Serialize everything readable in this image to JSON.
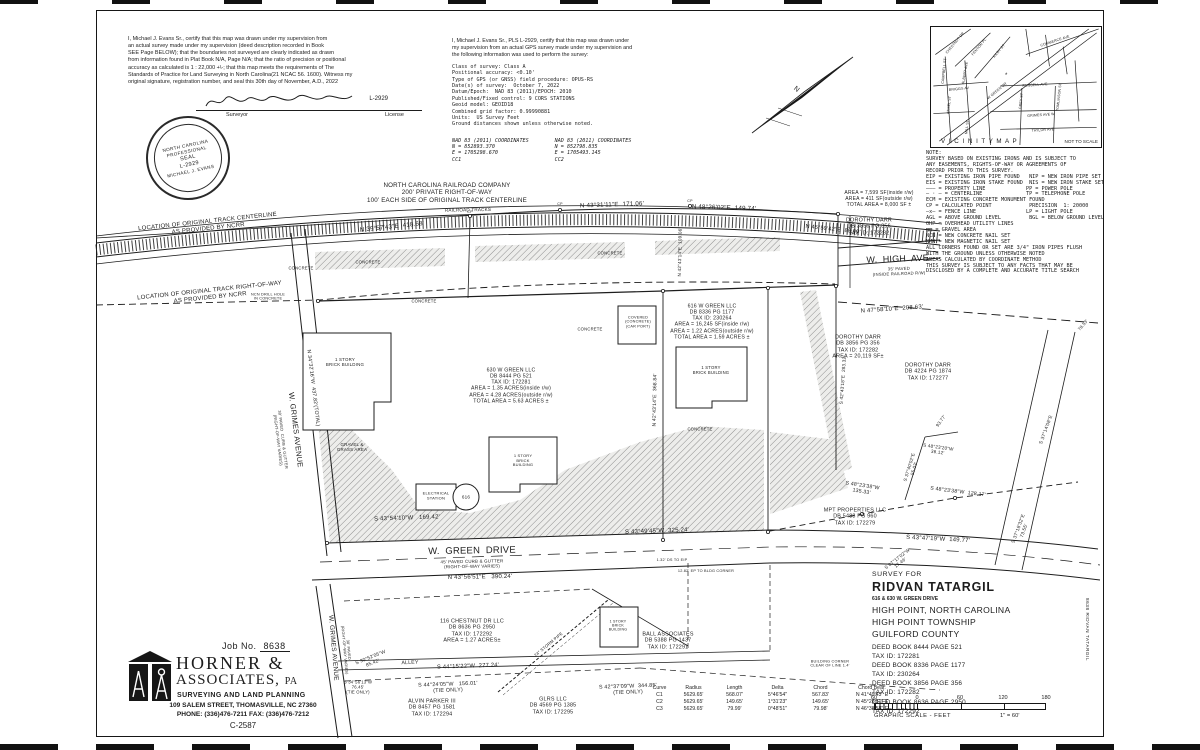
{
  "page": {
    "paper": "#ffffff",
    "ink": "#1d1d1d",
    "hatch_gray": "#8f8f8f"
  },
  "cert_left": {
    "body": "I, Michael J. Evans Sr., certify that this map was drawn under my supervision from\nan actual survey made under my supervision (deed description recorded in Book\nSEE Page BELOW); that the boundaries not surveyed are clearly indicated as drawn\nfrom information found in Plat Book N/A, Page N/A; that the ratio of precision or positional\naccuracy as calculated is 1 : 22,000 +\\-; that this map meets the requirements of The\nStandards of Practice for Land Surveying in North Carolina(21 NCAC 56. 1600). Witness my\noriginal signature, registration number, and seal this 30th day of November, A.D., 2022",
    "sig_license": "L-2929",
    "surveyor_label": "Surveyor",
    "license_label": "License"
  },
  "seal": {
    "arc_top": "NORTH CAROLINA",
    "line2": "PROFESSIONAL",
    "line3": "SEAL",
    "line4": "L-2929",
    "arc_bottom": "MICHAEL J. EVANS"
  },
  "cert_gps": {
    "intro": "I, Michael J. Evans Sr., PLS L-2929, certify that this map was drawn under\nmy supervision from an actual GPS survey made under my supervision and\nthe following information was used to perform the survey:",
    "details": "Class of survey: Class A\nPositional accuracy: <0.10'\nType of GPS (or GNSS) field procedure: OPUS-RS\nDate(s) of survey:  October 7, 2022\nDatum/Epoch:  NAD 83 (2011)/EPOCH: 2010\nPublished/Fixed control: 9 CORS STATIONS\nGeoid model: GEOID18\nCombined grid factor: 0.99990881\nUnits:  US Survey Feet\nGround distances shown unless otherwise noted.",
    "coords_left": "NAD 83 (2011) COORDINATES\nN = 852893.370\nE = 1705298.670\nCC1",
    "coords_right": "NAD 83 (2011) COORDINATES\nN = 852798.835\nE = 1705493.145\nCC2"
  },
  "vicinity": {
    "title": "V I C I N I T Y   M A P",
    "not_to_scale": "NOT TO SCALE",
    "site_marker": "*",
    "streets": [
      {
        "t": "CHESTNUT DR",
        "x": 24,
        "y": 16,
        "r": -50
      },
      {
        "t": "FENTON PL",
        "x": 48,
        "y": 20,
        "r": -50
      },
      {
        "t": "KILBY ST",
        "x": 68,
        "y": 24,
        "r": -50
      },
      {
        "t": "CAMPBELL ST",
        "x": 13,
        "y": 44,
        "r": -84
      },
      {
        "t": "ALBERT AVE",
        "x": 34,
        "y": 46,
        "r": -80
      },
      {
        "t": "BRIGGS AV",
        "x": 28,
        "y": 62,
        "r": -6
      },
      {
        "t": "ANSEL ST",
        "x": 18,
        "y": 78,
        "r": -84
      },
      {
        "t": "MILL ST",
        "x": 36,
        "y": 100,
        "r": -84
      },
      {
        "t": "W GREEN DR",
        "x": 66,
        "y": 64,
        "r": -40
      },
      {
        "t": "COMMERCE AVE",
        "x": 124,
        "y": 14,
        "r": -18
      },
      {
        "t": "RUSSELL AVE",
        "x": 104,
        "y": 58,
        "r": -4
      },
      {
        "t": "GREY ST",
        "x": 90,
        "y": 74,
        "r": -84
      },
      {
        "t": "TOMLINSON ST",
        "x": 128,
        "y": 70,
        "r": -84
      },
      {
        "t": "GRIMES AVE W",
        "x": 110,
        "y": 88,
        "r": -4
      },
      {
        "t": "TAYLOR AVE",
        "x": 112,
        "y": 103,
        "r": -4
      }
    ]
  },
  "notes": {
    "text": "NOTE:\nSURVEY BASED ON EXISTING IRONS AND IS SUBJECT TO\nANY EASEMENTS, RIGHTS-OF-WAY OR AGREEMENTS OF\nRECORD PRIOR TO THIS SURVEY.\nEIP = EXISTING IRON PIPE FOUND   NIP = NEW IRON PIPE SET\nEIS = EXISTING IRON STAKE FOUND  NIS = NEW IRON STAKE SET\n——— = PROPERTY LINE             PP = POWER POLE\n— · — = CENTERLINE              TP = TELEPHONE POLE\nECM = EXISTING CONCRETE MONUMENT FOUND\nCP = CALCULATED POINT            PRECISION  1: 20000\n—x— = FENCE LINE                LP = LIGHT POLE\nAGL = ABOVE GROUND LEVEL         BGL = BELOW GROUND LEVEL\nOHP = OVERHEAD UTILITY LINES\n▨▨ = GRAVEL AREA\nNCN = NEW CONCRETE NAIL SET\nNMN = NEW MAGNETIC NAIL SET\nALL CORNERS FOUND OR SET ARE 3/4\" IRON PIPES FLUSH\nWITH THE GROUND UNLESS OTHERWISE NOTED\nAREAS CALCULATED BY COORDINATE METHOD\nTHIS SURVEY IS SUBJECT TO ANY FACTS THAT MAY BE\nDISCLOSED BY A COMPLETE AND ACCURATE TITLE SEARCH"
  },
  "title_block": {
    "survey_for": "SURVEY FOR",
    "client": "RIDVAN TATARGIL",
    "address": "616 & 630 W. GREEN DRIVE",
    "city": "HIGH POINT, NORTH CAROLINA",
    "township": "HIGH POINT TOWNSHIP",
    "county": "GUILFORD COUNTY",
    "deeds": [
      "DEED BOOK 8444 PAGE 521",
      "TAX ID: 172281",
      "DEED BOOK 8336 PAGE 1177",
      "TAX ID: 230264",
      "DEED BOOK 3856 PAGE 356",
      "TAX ID: 172282",
      "DEED BOOK 8636 PAGE 2950",
      "TAX ID: 172292"
    ]
  },
  "firm": {
    "job_label": "Job No.",
    "job_no": "8638",
    "name_line1": "HORNER  &",
    "name_line2": "ASSOCIATES,",
    "name_suffix": "PA",
    "tagline": "SURVEYING AND LAND PLANNING",
    "address": "109 SALEM STREET, THOMASVILLE, NC  27360",
    "phone": "PHONE: (336)476-7211   FAX: (336)476-7212",
    "license_no": "C-2587"
  },
  "curve_table": {
    "headers": [
      "Curve",
      "Radius",
      "Length",
      "Delta",
      "Chord",
      "Chord Bear."
    ],
    "rows": [
      [
        "C1",
        "5629.65'",
        "568.07'",
        "5°46'54\"",
        "567.83'",
        "N 41°49'43\" E"
      ],
      [
        "C2",
        "5629.65'",
        "149.65'",
        "1°31'23\"",
        "149.65'",
        "N 45°28'51\" E"
      ],
      [
        "C3",
        "5629.65'",
        "79.99'",
        "0°48'51\"",
        "79.98'",
        "N 46°38'58\" E"
      ]
    ]
  },
  "scale_bar": {
    "numbers": [
      "60",
      "0",
      "60",
      "120",
      "180"
    ],
    "caption": "GRAPHIC SCALE - FEET",
    "ratio": "1\" = 60'"
  },
  "margin_note": "8638 RIDVAN TATARGIL",
  "map": {
    "labels": [
      {
        "t": "NORTH CAROLINA RAILROAD COMPANY\n200' PRIVATE RIGHT-OF-WAY\n100' EACH SIDE OF ORIGINAL TRACK CENTERLINE",
        "x": 447,
        "y": 193,
        "r": 0,
        "s": 6.2
      },
      {
        "t": "RAILROAD TRACKS",
        "x": 468,
        "y": 210,
        "r": -1,
        "s": 4.6
      },
      {
        "t": "LOCATION OF ORIGINAL TRACK CENTERLINE\nAS PROVIDED BY NCRR",
        "x": 208,
        "y": 226,
        "r": -6,
        "s": 6
      },
      {
        "t": "LOCATION OF ORIGINAL TRACK RIGHT-OF-WAY\nAS PROVIDED BY NCRR",
        "x": 210,
        "y": 295,
        "r": -6,
        "s": 6
      },
      {
        "t": "N 39°57'43\"E  418.68'",
        "x": 392,
        "y": 227,
        "r": -6,
        "s": 6.2
      },
      {
        "t": "N 43°31'11\"E  171.06'",
        "x": 612,
        "y": 205,
        "r": -2,
        "s": 6.2
      },
      {
        "t": "N 48°26'02\"E  149.74'",
        "x": 724,
        "y": 208,
        "r": 2,
        "s": 6.2
      },
      {
        "t": "N 45°59'42\"E  80.00'",
        "x": 833,
        "y": 230,
        "r": 6,
        "s": 5.6
      },
      {
        "t": "W.  HIGH  AVE.",
        "x": 899,
        "y": 259,
        "r": -2,
        "s": 9
      },
      {
        "t": "35' PAVED\n(INSIDE RAILROAD R/W)",
        "x": 899,
        "y": 272,
        "r": -2,
        "s": 4.2
      },
      {
        "t": "AREA = 7,599 SF(inside r/w)\nAREA = 411 SF(outside r/w)\nTOTAL AREA = 8,000 SF ±",
        "x": 879,
        "y": 200,
        "r": 0,
        "s": 5
      },
      {
        "t": "DOROTHY DARR\nDB 3856 PG 356\nTAX ID: 172282",
        "x": 869,
        "y": 227,
        "r": 0,
        "s": 5.4
      },
      {
        "t": "N 47°58'10\"E  208.63'",
        "x": 892,
        "y": 310,
        "r": -4,
        "s": 6
      },
      {
        "t": "DOROTHY DARR\nDB 3856 PG 356\nTAX ID: 172282\nAREA = 20,119 SF±",
        "x": 858,
        "y": 347,
        "r": 0,
        "s": 5.4
      },
      {
        "t": "DOROTHY DARR\nDB 4224 PG 1874\nTAX ID: 172277",
        "x": 928,
        "y": 372,
        "r": 0,
        "s": 5.4
      },
      {
        "t": "616 W GREEN LLC\nDB 8336 PG 1177\nTAX ID: 230264\nAREA = 16,245 SF(inside r/w)\nAREA = 1.22 ACRES(outside r/w)\nTOTAL AREA = 1.59 ACRES ±",
        "x": 712,
        "y": 322,
        "r": 0,
        "s": 5.2
      },
      {
        "t": "630 W GREEN LLC\nDB 8444 PG 521\nTAX ID: 172281\nAREA = 1.35 ACRES(inside r/w)\nAREA = 4.28 ACRES(outside r/w)\nTOTAL AREA = 5.63 ACRES ±",
        "x": 511,
        "y": 386,
        "r": 0,
        "s": 5.2
      },
      {
        "t": "1 STORY\nBRICK BUILDING",
        "x": 345,
        "y": 362,
        "r": 0,
        "s": 4.4
      },
      {
        "t": "1 STORY\nBRICK\nBUILDING",
        "x": 523,
        "y": 461,
        "r": 0,
        "s": 4
      },
      {
        "t": "1 STORY\nBRICK BUILDING",
        "x": 711,
        "y": 371,
        "r": 0,
        "s": 4.2
      },
      {
        "t": "ELECTRICAL\nSTATION",
        "x": 436,
        "y": 496,
        "r": 0,
        "s": 4
      },
      {
        "t": "616",
        "x": 466,
        "y": 497,
        "r": 0,
        "s": 4.6
      },
      {
        "t": "GRAVEL &\nGRASS AREA",
        "x": 352,
        "y": 447,
        "r": 0,
        "s": 4.4
      },
      {
        "t": "CONCRETE",
        "x": 301,
        "y": 269,
        "r": 0,
        "s": 4.2
      },
      {
        "t": "CONCRETE",
        "x": 368,
        "y": 263,
        "r": 0,
        "s": 4.2
      },
      {
        "t": "CONCRETE",
        "x": 610,
        "y": 254,
        "r": 0,
        "s": 4.2
      },
      {
        "t": "CONCRETE",
        "x": 424,
        "y": 302,
        "r": 0,
        "s": 4.2
      },
      {
        "t": "CONCRETE",
        "x": 590,
        "y": 330,
        "r": 0,
        "s": 4.2
      },
      {
        "t": "CONCRETE",
        "x": 700,
        "y": 430,
        "r": 0,
        "s": 4.2
      },
      {
        "t": "COVERED\n(CONCRETE)\n(CAR PORT)",
        "x": 638,
        "y": 322,
        "r": 0,
        "s": 3.8
      },
      {
        "t": "S 43°54'10\"W   169.42'",
        "x": 407,
        "y": 519,
        "r": -2,
        "s": 6
      },
      {
        "t": "S 43°49'45\"W  325.24'",
        "x": 657,
        "y": 532,
        "r": -2,
        "s": 6
      },
      {
        "t": "S 43°47'19\"W  149.77'",
        "x": 938,
        "y": 540,
        "r": 3,
        "s": 6
      },
      {
        "t": "W.  GREEN  DRIVE",
        "x": 472,
        "y": 551,
        "r": -1,
        "s": 9.5
      },
      {
        "t": "45' PAVED CURB & GUTTER\n(RIGHT-OF-WAY VARIES)",
        "x": 472,
        "y": 564,
        "r": -1,
        "s": 4.4
      },
      {
        "t": "N 43°56'51\"E   390.24'",
        "x": 480,
        "y": 578,
        "r": -1,
        "s": 6
      },
      {
        "t": "MPT PROPERTIES LLC\nDB 5488 PG 960\nTAX ID: 172279",
        "x": 855,
        "y": 517,
        "r": 0,
        "s": 5.4
      },
      {
        "t": "S 48°23'38\"W\n135.33'",
        "x": 862,
        "y": 489,
        "r": 9,
        "s": 5.2
      },
      {
        "t": "S 48°23'38\"W  128.17'",
        "x": 958,
        "y": 492,
        "r": 7,
        "s": 5.2
      },
      {
        "t": "S 37°40'02\"E\n55.03'",
        "x": 912,
        "y": 468,
        "r": -73,
        "s": 4.6
      },
      {
        "t": "S 48°23'20\"W\n36.12'",
        "x": 938,
        "y": 450,
        "r": 8,
        "s": 4.6
      },
      {
        "t": "S 37°14'08\"E",
        "x": 1047,
        "y": 430,
        "r": -70,
        "s": 4.8
      },
      {
        "t": "S 37°18'32\"E\n73.55'",
        "x": 1022,
        "y": 530,
        "r": -70,
        "s": 4.8
      },
      {
        "t": "W. GRIMES AVENUE",
        "x": 295,
        "y": 430,
        "r": 83,
        "s": 7.5
      },
      {
        "t": "30' PAVED  CURB & GUTTER\n(RIGHT-OF-WAY VARIES)",
        "x": 280,
        "y": 440,
        "r": 83,
        "s": 4
      },
      {
        "t": "N 34°32'16\"W  437.82'(TOTAL)",
        "x": 313,
        "y": 388,
        "r": 83,
        "s": 5.2
      },
      {
        "t": "W. GRIMES AVENUE",
        "x": 333,
        "y": 648,
        "r": 85,
        "s": 6.5
      },
      {
        "t": "30' PAVED\n(RIGHT-OF-WAY VARIES)",
        "x": 346,
        "y": 650,
        "r": 85,
        "s": 3.8
      },
      {
        "t": "116 CHESTNUT DR LLC\nDB 8636 PG 2950\nTAX ID: 172292\nAREA = 1.27 ACRES±",
        "x": 472,
        "y": 631,
        "r": 0,
        "s": 5.4
      },
      {
        "t": "24\" STORM PIPE",
        "x": 549,
        "y": 645,
        "r": -40,
        "s": 4.2
      },
      {
        "t": "BALL ASSOCIATES\nDB 5388 PG 1437\nTAX ID: 172291",
        "x": 668,
        "y": 641,
        "r": 0,
        "s": 5.4
      },
      {
        "t": "1 STORY\nBRICK\nBUILDING",
        "x": 618,
        "y": 626,
        "r": 0,
        "s": 3.6
      },
      {
        "t": "GLRS LLC\nDB 4569 PG 1385\nTAX ID: 172295",
        "x": 553,
        "y": 706,
        "r": 0,
        "s": 5.4
      },
      {
        "t": "ALVIN PARKER III\nDB 8457 PG 1581\nTAX ID: 172294",
        "x": 432,
        "y": 708,
        "r": 0,
        "s": 5.4
      },
      {
        "t": "S 44°15'22\"W  277.24'",
        "x": 468,
        "y": 667,
        "r": -2,
        "s": 5.8
      },
      {
        "t": "S 44°24'05\"W   156.01'\n(TIE ONLY)",
        "x": 448,
        "y": 688,
        "r": -2,
        "s": 5.4
      },
      {
        "t": "S 42°37'09\"W  344.85'\n(TIE ONLY)",
        "x": 628,
        "y": 690,
        "r": -2,
        "s": 5.4
      },
      {
        "t": "S 30°52'05\"W\n85.42'",
        "x": 372,
        "y": 661,
        "r": -22,
        "s": 4.8
      },
      {
        "t": "S 34°56'13\"W\n76.45'\n(TIE ONLY)",
        "x": 358,
        "y": 688,
        "r": 0,
        "s": 4.2
      },
      {
        "t": "ALLEY",
        "x": 410,
        "y": 663,
        "r": -2,
        "s": 5.2
      },
      {
        "t": "S 07°17'02\"W\n17.46'",
        "x": 899,
        "y": 561,
        "r": -38,
        "s": 4.6
      },
      {
        "t": "N 42°43'14\"E  368.84'",
        "x": 656,
        "y": 400,
        "r": -89,
        "s": 5
      },
      {
        "t": "N 42°43'14\"E  109.06'",
        "x": 680,
        "y": 252,
        "r": -89,
        "s": 4.6
      },
      {
        "t": "S 42°43'18\"E  283.32'",
        "x": 843,
        "y": 380,
        "r": -86,
        "s": 4.6
      },
      {
        "t": "93.77'",
        "x": 941,
        "y": 421,
        "r": -55,
        "s": 4.6
      },
      {
        "t": "BUILDING CORNER\nCLEAR OF LINE 1.4'",
        "x": 830,
        "y": 664,
        "r": 0,
        "s": 3.8
      },
      {
        "t": "1.32' DS TO EIP",
        "x": 672,
        "y": 560,
        "r": 0,
        "s": 3.8
      },
      {
        "t": "12.82' EP TO BLDG CORNER",
        "x": 706,
        "y": 571,
        "r": 0,
        "s": 3.8
      },
      {
        "t": "NCN DRILL HOLE\nIN CONCRETE",
        "x": 268,
        "y": 297,
        "r": 0,
        "s": 3.8
      },
      {
        "t": "CP",
        "x": 560,
        "y": 204,
        "r": 0,
        "s": 3.6
      },
      {
        "t": "CP",
        "x": 690,
        "y": 201,
        "r": 0,
        "s": 3.6
      },
      {
        "t": "CP",
        "x": 470,
        "y": 212,
        "r": 0,
        "s": 3.6
      },
      {
        "t": "78.53'",
        "x": 1083,
        "y": 325,
        "r": -50,
        "s": 4.4
      },
      {
        "t": "N",
        "x": 796,
        "y": 90,
        "r": 38,
        "s": 7
      }
    ]
  }
}
